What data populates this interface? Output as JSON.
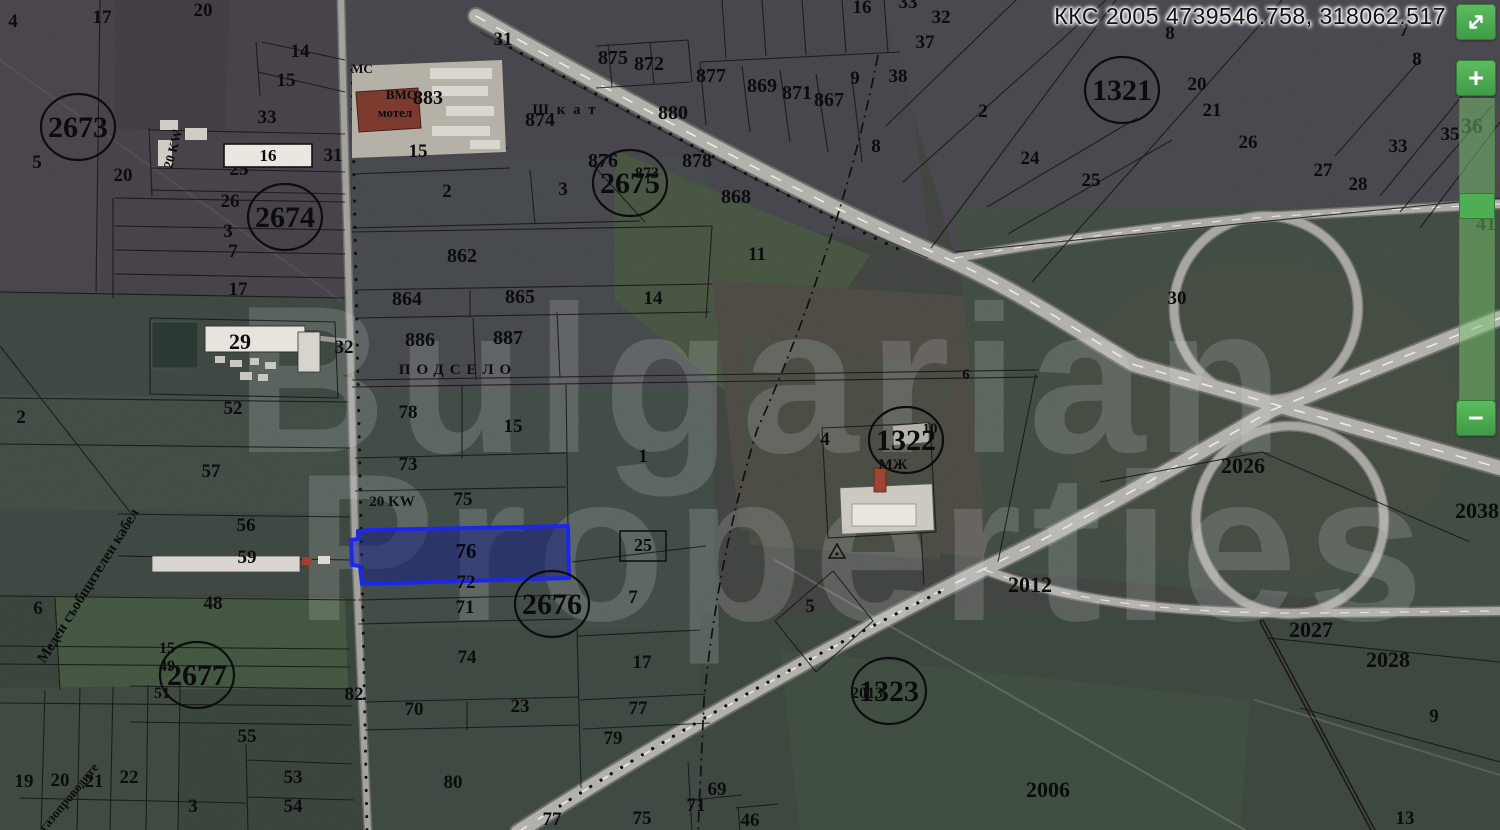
{
  "overlay": {
    "coordinates": "ККС 2005 4739546.758, 318062.517"
  },
  "zoom_controls": {
    "zoom_in_label": "+",
    "zoom_out_label": "−",
    "expand_icon": "diagonal-resize-arrows"
  },
  "watermark": {
    "line1": "Bulgarian",
    "line2": "Properties"
  },
  "selected_parcel": {
    "number": "76",
    "outline_color": "#1c27ea"
  },
  "map": {
    "cadastral_regions": [
      {
        "n": "2673",
        "x": 78,
        "y": 137
      },
      {
        "n": "2674",
        "x": 285,
        "y": 227
      },
      {
        "n": "2675",
        "x": 630,
        "y": 193
      },
      {
        "n": "2676",
        "x": 552,
        "y": 614
      },
      {
        "n": "2677",
        "x": 197,
        "y": 685
      },
      {
        "n": "1321",
        "x": 1122,
        "y": 100
      },
      {
        "n": "1322",
        "x": 906,
        "y": 450
      },
      {
        "n": "1323",
        "x": 889,
        "y": 701
      }
    ],
    "parcel_labels": [
      {
        "t": "4",
        "x": 13,
        "y": 27
      },
      {
        "t": "17",
        "x": 102,
        "y": 23
      },
      {
        "t": "20",
        "x": 203,
        "y": 16
      },
      {
        "t": "14",
        "x": 300,
        "y": 57
      },
      {
        "t": "15",
        "x": 286,
        "y": 86
      },
      {
        "t": "33",
        "x": 267,
        "y": 123
      },
      {
        "t": "25",
        "x": 239,
        "y": 175
      },
      {
        "t": "20",
        "x": 123,
        "y": 181
      },
      {
        "t": "26",
        "x": 230,
        "y": 207
      },
      {
        "t": "3",
        "x": 228,
        "y": 237
      },
      {
        "t": "7",
        "x": 233,
        "y": 257
      },
      {
        "t": "17",
        "x": 238,
        "y": 295
      },
      {
        "t": "5",
        "x": 37,
        "y": 168
      },
      {
        "t": "29",
        "x": 240,
        "y": 349,
        "s": 22
      },
      {
        "t": "32",
        "x": 344,
        "y": 353
      },
      {
        "t": "52",
        "x": 233,
        "y": 414
      },
      {
        "t": "2",
        "x": 21,
        "y": 423
      },
      {
        "t": "57",
        "x": 211,
        "y": 477
      },
      {
        "t": "56",
        "x": 246,
        "y": 531
      },
      {
        "t": "59",
        "x": 247,
        "y": 563
      },
      {
        "t": "6",
        "x": 38,
        "y": 614
      },
      {
        "t": "48",
        "x": 213,
        "y": 609
      },
      {
        "t": "15",
        "x": 167,
        "y": 653,
        "s": 16
      },
      {
        "t": "49",
        "x": 167,
        "y": 671,
        "s": 16
      },
      {
        "t": "51",
        "x": 162,
        "y": 698,
        "s": 16
      },
      {
        "t": "55",
        "x": 247,
        "y": 742
      },
      {
        "t": "19",
        "x": 24,
        "y": 787
      },
      {
        "t": "20",
        "x": 60,
        "y": 786
      },
      {
        "t": "21",
        "x": 94,
        "y": 787
      },
      {
        "t": "22",
        "x": 129,
        "y": 783
      },
      {
        "t": "3",
        "x": 193,
        "y": 812
      },
      {
        "t": "53",
        "x": 293,
        "y": 783
      },
      {
        "t": "54",
        "x": 293,
        "y": 812
      },
      {
        "t": "82",
        "x": 354,
        "y": 700
      },
      {
        "t": "31",
        "x": 503,
        "y": 45
      },
      {
        "t": "МС",
        "x": 362,
        "y": 73,
        "s": 13
      },
      {
        "t": "ВМС",
        "x": 401,
        "y": 99,
        "s": 13
      },
      {
        "t": "мотел",
        "x": 395,
        "y": 117,
        "s": 13
      },
      {
        "t": "883",
        "x": 428,
        "y": 104,
        "s": 20
      },
      {
        "t": "31",
        "x": 333,
        "y": 161
      },
      {
        "t": "15",
        "x": 418,
        "y": 157
      },
      {
        "t": "2",
        "x": 447,
        "y": 197
      },
      {
        "t": "3",
        "x": 563,
        "y": 195
      },
      {
        "t": "875",
        "x": 613,
        "y": 64,
        "s": 20
      },
      {
        "t": "872",
        "x": 649,
        "y": 70,
        "s": 20
      },
      {
        "t": "877",
        "x": 711,
        "y": 82,
        "s": 20
      },
      {
        "t": "869",
        "x": 762,
        "y": 92,
        "s": 20
      },
      {
        "t": "871",
        "x": 797,
        "y": 99,
        "s": 20
      },
      {
        "t": "867",
        "x": 829,
        "y": 106,
        "s": 20
      },
      {
        "t": "9",
        "x": 855,
        "y": 84
      },
      {
        "t": "874",
        "x": 540,
        "y": 126,
        "s": 20
      },
      {
        "t": "880",
        "x": 673,
        "y": 119,
        "s": 20
      },
      {
        "t": "876",
        "x": 603,
        "y": 167,
        "s": 20
      },
      {
        "t": "873",
        "x": 647,
        "y": 178,
        "s": 16
      },
      {
        "t": "878",
        "x": 697,
        "y": 167,
        "s": 20
      },
      {
        "t": "868",
        "x": 736,
        "y": 203,
        "s": 20
      },
      {
        "t": "11",
        "x": 757,
        "y": 260
      },
      {
        "t": "14",
        "x": 653,
        "y": 304
      },
      {
        "t": "862",
        "x": 462,
        "y": 262,
        "s": 20
      },
      {
        "t": "864",
        "x": 407,
        "y": 305,
        "s": 20
      },
      {
        "t": "865",
        "x": 520,
        "y": 303,
        "s": 20
      },
      {
        "t": "886",
        "x": 420,
        "y": 346,
        "s": 20
      },
      {
        "t": "887",
        "x": 508,
        "y": 344,
        "s": 20
      },
      {
        "t": "78",
        "x": 408,
        "y": 418
      },
      {
        "t": "15",
        "x": 513,
        "y": 432
      },
      {
        "t": "73",
        "x": 408,
        "y": 470
      },
      {
        "t": "20 KW",
        "x": 392,
        "y": 506,
        "s": 15
      },
      {
        "t": "75",
        "x": 463,
        "y": 505
      },
      {
        "t": "72",
        "x": 466,
        "y": 588
      },
      {
        "t": "71",
        "x": 465,
        "y": 613
      },
      {
        "t": "7",
        "x": 633,
        "y": 603
      },
      {
        "t": "74",
        "x": 467,
        "y": 663
      },
      {
        "t": "17",
        "x": 642,
        "y": 668
      },
      {
        "t": "70",
        "x": 414,
        "y": 715
      },
      {
        "t": "23",
        "x": 520,
        "y": 712
      },
      {
        "t": "77",
        "x": 638,
        "y": 714
      },
      {
        "t": "79",
        "x": 613,
        "y": 744
      },
      {
        "t": "80",
        "x": 453,
        "y": 788
      },
      {
        "t": "77",
        "x": 552,
        "y": 825
      },
      {
        "t": "75",
        "x": 642,
        "y": 824
      },
      {
        "t": "69",
        "x": 717,
        "y": 795
      },
      {
        "t": "71",
        "x": 696,
        "y": 811
      },
      {
        "t": "46",
        "x": 750,
        "y": 826
      },
      {
        "t": "1",
        "x": 643,
        "y": 462
      },
      {
        "t": "4",
        "x": 825,
        "y": 445
      },
      {
        "t": "10",
        "x": 930,
        "y": 433,
        "s": 15
      },
      {
        "t": "МЖ",
        "x": 893,
        "y": 469,
        "s": 15
      },
      {
        "t": "6",
        "x": 966,
        "y": 379,
        "s": 15
      },
      {
        "t": "5",
        "x": 810,
        "y": 612
      },
      {
        "t": "2013",
        "x": 867,
        "y": 698,
        "s": 16
      },
      {
        "t": "2012",
        "x": 1030,
        "y": 592,
        "s": 22
      },
      {
        "t": "2006",
        "x": 1048,
        "y": 797,
        "s": 22
      },
      {
        "t": "16",
        "x": 862,
        "y": 13
      },
      {
        "t": "33",
        "x": 908,
        "y": 8
      },
      {
        "t": "32",
        "x": 941,
        "y": 23
      },
      {
        "t": "37",
        "x": 925,
        "y": 48
      },
      {
        "t": "38",
        "x": 898,
        "y": 82
      },
      {
        "t": "2",
        "x": 983,
        "y": 117
      },
      {
        "t": "8",
        "x": 876,
        "y": 152
      },
      {
        "t": "8",
        "x": 1170,
        "y": 39
      },
      {
        "t": "7",
        "x": 1404,
        "y": 36
      },
      {
        "t": "8",
        "x": 1417,
        "y": 65
      },
      {
        "t": "20",
        "x": 1197,
        "y": 90
      },
      {
        "t": "21",
        "x": 1212,
        "y": 116
      },
      {
        "t": "24",
        "x": 1030,
        "y": 164
      },
      {
        "t": "25",
        "x": 1091,
        "y": 186
      },
      {
        "t": "26",
        "x": 1248,
        "y": 148
      },
      {
        "t": "27",
        "x": 1323,
        "y": 176
      },
      {
        "t": "28",
        "x": 1358,
        "y": 190
      },
      {
        "t": "33",
        "x": 1398,
        "y": 152
      },
      {
        "t": "35",
        "x": 1450,
        "y": 140
      },
      {
        "t": "36",
        "x": 1472,
        "y": 133,
        "s": 22
      },
      {
        "t": "41",
        "x": 1486,
        "y": 230,
        "s": 20
      },
      {
        "t": "30",
        "x": 1177,
        "y": 304
      },
      {
        "t": "2026",
        "x": 1243,
        "y": 473,
        "s": 22
      },
      {
        "t": "2038",
        "x": 1477,
        "y": 518,
        "s": 22
      },
      {
        "t": "2027",
        "x": 1311,
        "y": 637,
        "s": 22
      },
      {
        "t": "2028",
        "x": 1388,
        "y": 667,
        "s": 22
      },
      {
        "t": "9",
        "x": 1434,
        "y": 722
      },
      {
        "t": "13",
        "x": 1405,
        "y": 824
      }
    ],
    "rotated_labels": [
      {
        "t": "Меден съобщителен кабел",
        "x": 92,
        "y": 588,
        "r": -58,
        "s": 15
      },
      {
        "t": "газопроводите",
        "x": 72,
        "y": 800,
        "r": -50,
        "s": 13
      },
      {
        "t": "20 KW",
        "x": 177,
        "y": 150,
        "r": -75,
        "s": 13
      },
      {
        "t": "ПОДСЕЛО",
        "x": 458,
        "y": 374,
        "r": 0,
        "s": 15,
        "ls": 6
      },
      {
        "t": "Ш к а т",
        "x": 565,
        "y": 114,
        "r": 0,
        "s": 15,
        "ls": 2
      }
    ],
    "boxed_labels": [
      {
        "t": "16",
        "x": 268,
        "y": 161,
        "bx": 224,
        "by": 144,
        "bw": 88,
        "bh": 23,
        "fill": "#e9e7df",
        "fs": 17
      },
      {
        "t": "25",
        "x": 643,
        "y": 551,
        "bx": 620,
        "by": 531,
        "bw": 46,
        "bh": 30,
        "fill": "none",
        "fs": 18
      }
    ]
  }
}
